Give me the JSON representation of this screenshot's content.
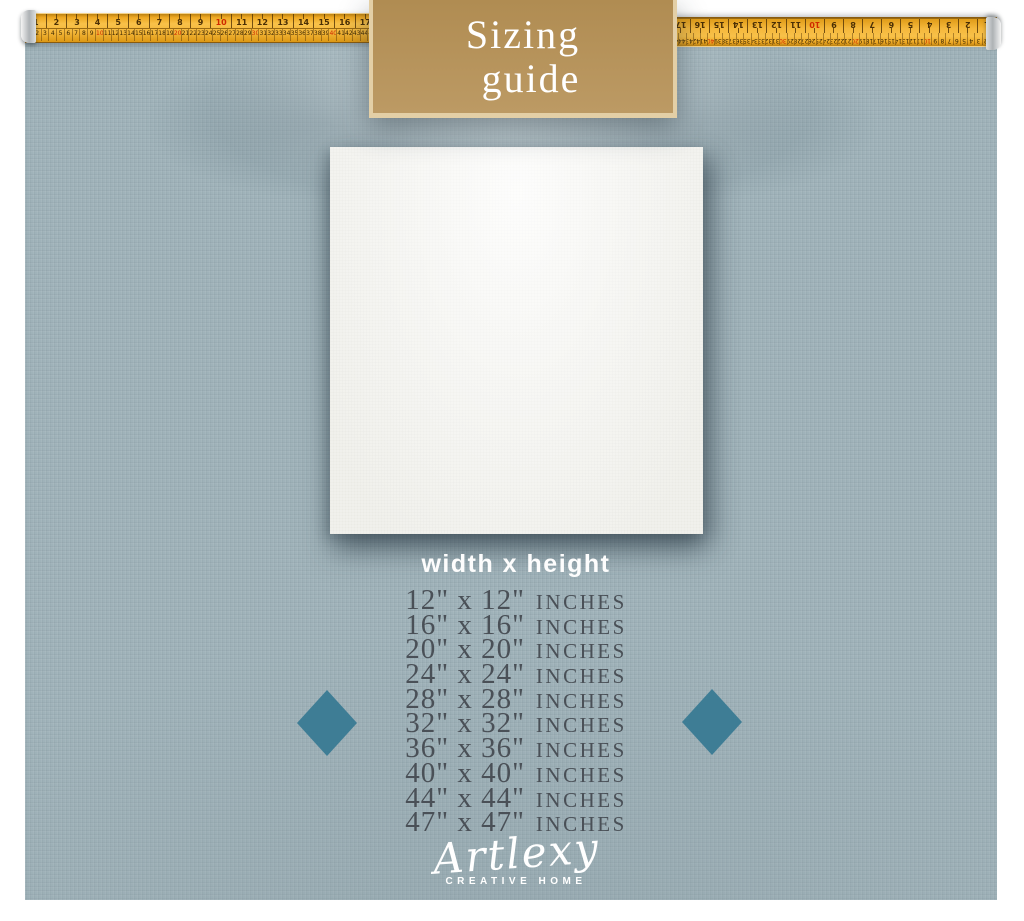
{
  "badge": {
    "title_line1": "Sizing",
    "title_line2": "guide"
  },
  "ruler": {
    "inch_numbers": [
      "1",
      "2",
      "3",
      "4",
      "5",
      "6",
      "7",
      "8",
      "9",
      "10",
      "11",
      "12",
      "13",
      "14",
      "15",
      "16",
      "17"
    ],
    "cm_numbers": [
      "1",
      "2",
      "3",
      "4",
      "5",
      "6",
      "7",
      "8",
      "9",
      "10",
      "11",
      "12",
      "13",
      "14",
      "15",
      "16",
      "17",
      "18",
      "19",
      "20",
      "21",
      "22",
      "23",
      "24",
      "25",
      "26",
      "27",
      "28",
      "29",
      "30",
      "31",
      "32",
      "33",
      "34",
      "35",
      "36",
      "37",
      "38",
      "39",
      "40",
      "41",
      "42",
      "43",
      "44",
      "45"
    ]
  },
  "size_table": {
    "heading": "width x height",
    "rows": [
      {
        "dim": "12\" x 12\"",
        "unit": "INCHES"
      },
      {
        "dim": "16\" x 16\"",
        "unit": "INCHES"
      },
      {
        "dim": "20\" x 20\"",
        "unit": "INCHES"
      },
      {
        "dim": "24\" x 24\"",
        "unit": "INCHES"
      },
      {
        "dim": "28\" x 28\"",
        "unit": "INCHES"
      },
      {
        "dim": "32\" x 32\"",
        "unit": "INCHES"
      },
      {
        "dim": "36\" x 36\"",
        "unit": "INCHES"
      },
      {
        "dim": "40\" x 40\"",
        "unit": "INCHES"
      },
      {
        "dim": "44\" x 44\"",
        "unit": "INCHES"
      },
      {
        "dim": "47\" x 47\"",
        "unit": "INCHES"
      }
    ]
  },
  "footer": {
    "brand": "Artlexy",
    "tagline": "CREATIVE HOME"
  },
  "colors": {
    "wall": "#9fb2b9",
    "badge_gold": "#b5955f",
    "badge_border": "#e3cfa6",
    "tape_yellow": "#f5b83c",
    "diamond_teal": "#3e7d95",
    "size_text": "#4a5057",
    "canvas_white": "#f5f5f1"
  }
}
